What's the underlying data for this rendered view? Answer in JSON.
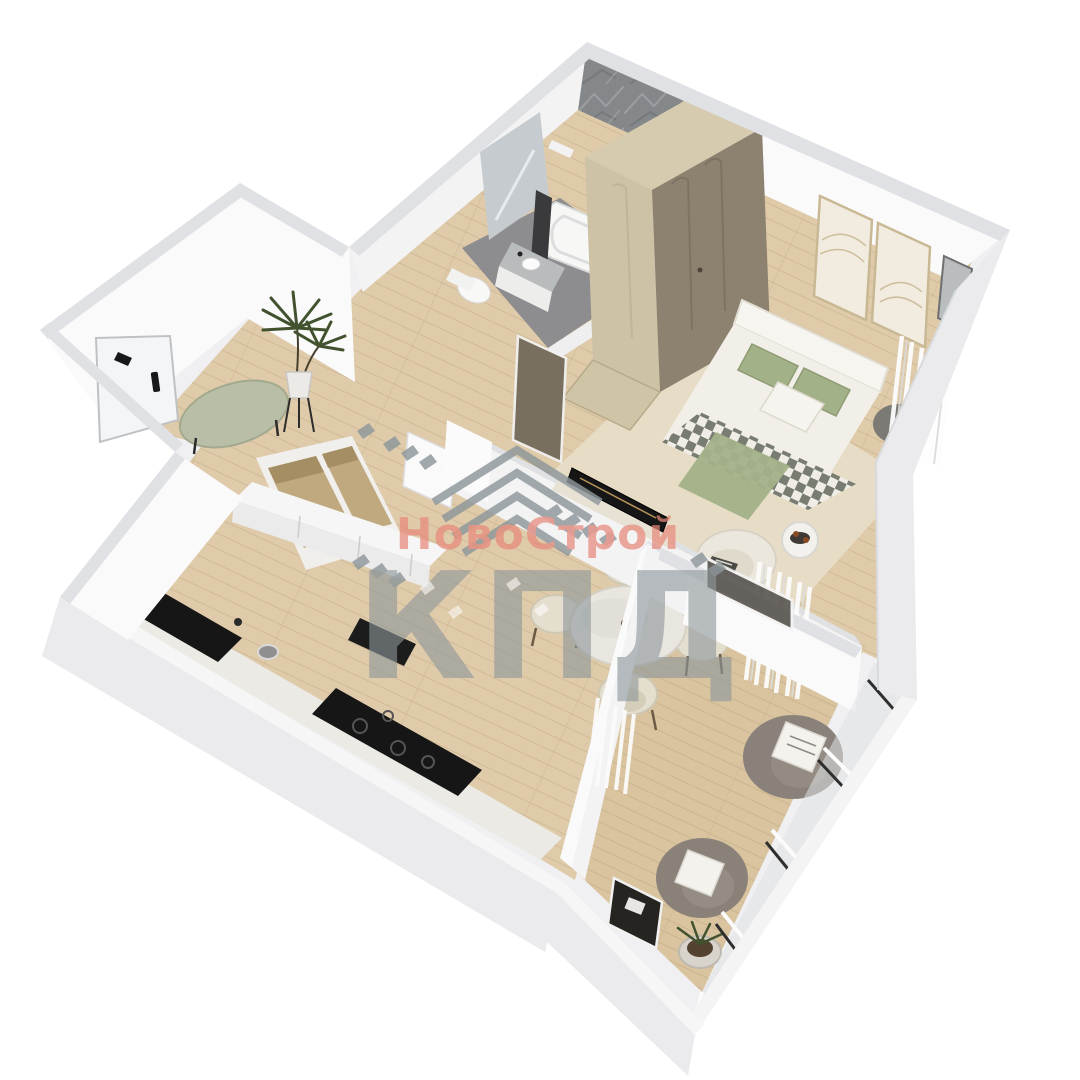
{
  "watermark": {
    "line1": "НовоСтрой",
    "line2": "КПД",
    "line1_color": "#e8897a",
    "line2_color": "#8e979b",
    "logo": "roof-chevrons-icon"
  },
  "palette": {
    "bg": "#ffffff",
    "wallMass": "#f0f0f2",
    "wallFace": "#fafafa",
    "wallFace2": "#f3f3f4",
    "wallBand": "#e0e1e4",
    "wallOuter": "#ebebee",
    "tile": "#85888b",
    "tileLight": "#a6a9ac",
    "floorWood": "#dfcbaa",
    "floorWood2": "#d9c49f",
    "plank": "#c2ab87",
    "bathFloor": "#8d8d8f",
    "rug": "#e7ddc9",
    "wardrobeTop": "#d6cbae",
    "wardrobeLight": "#cdc2a5",
    "wardrobeDark": "#8d8170",
    "bedWhite": "#f2efe8",
    "sage": "#a3b188",
    "checkDark": "#787c71",
    "boucle": "#ece7dd",
    "grayChair": "#89817a",
    "benchSage": "#b9bfa6",
    "counterTop": "#eceae4",
    "appliance": "#161616",
    "glass": "#dfe2e3",
    "glassDark": "#6f6657",
    "storageTan": "#c0a97f",
    "storageShade": "#937c52",
    "plantGreen": "#42522f",
    "mirror": "#c5cbce",
    "art": "#f1ecdf",
    "artLine": "#c9b894"
  }
}
